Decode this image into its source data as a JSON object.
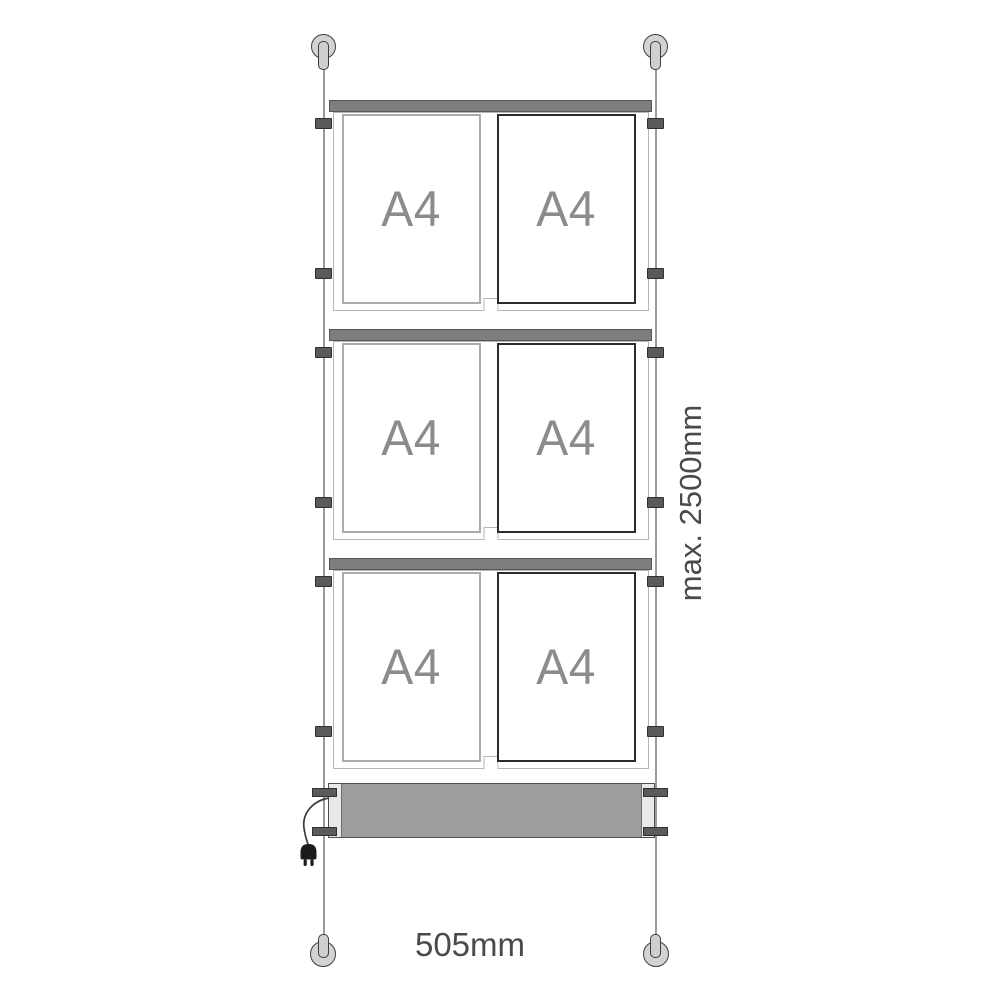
{
  "diagram": {
    "description": "cable suspended poster display kit with three 2xA4 panels and light box",
    "rows": [
      {
        "pockets": [
          {
            "label": "A4"
          },
          {
            "label": "A4"
          }
        ]
      },
      {
        "pockets": [
          {
            "label": "A4"
          },
          {
            "label": "A4"
          }
        ]
      },
      {
        "pockets": [
          {
            "label": "A4"
          },
          {
            "label": "A4"
          }
        ]
      }
    ],
    "dimensions": {
      "width_label": "505mm",
      "max_height_label": "max. 2500mm"
    },
    "colors": {
      "rail": "#7e7e7e",
      "lightbox_fill": "#9d9d9d",
      "pocket_label_text": "#8c8c8c",
      "dimension_text": "#4a4a4a",
      "clamp": "#5a5a5a",
      "cable": "#9b9b9b",
      "fixing_fill": "#d3d3d3"
    }
  }
}
